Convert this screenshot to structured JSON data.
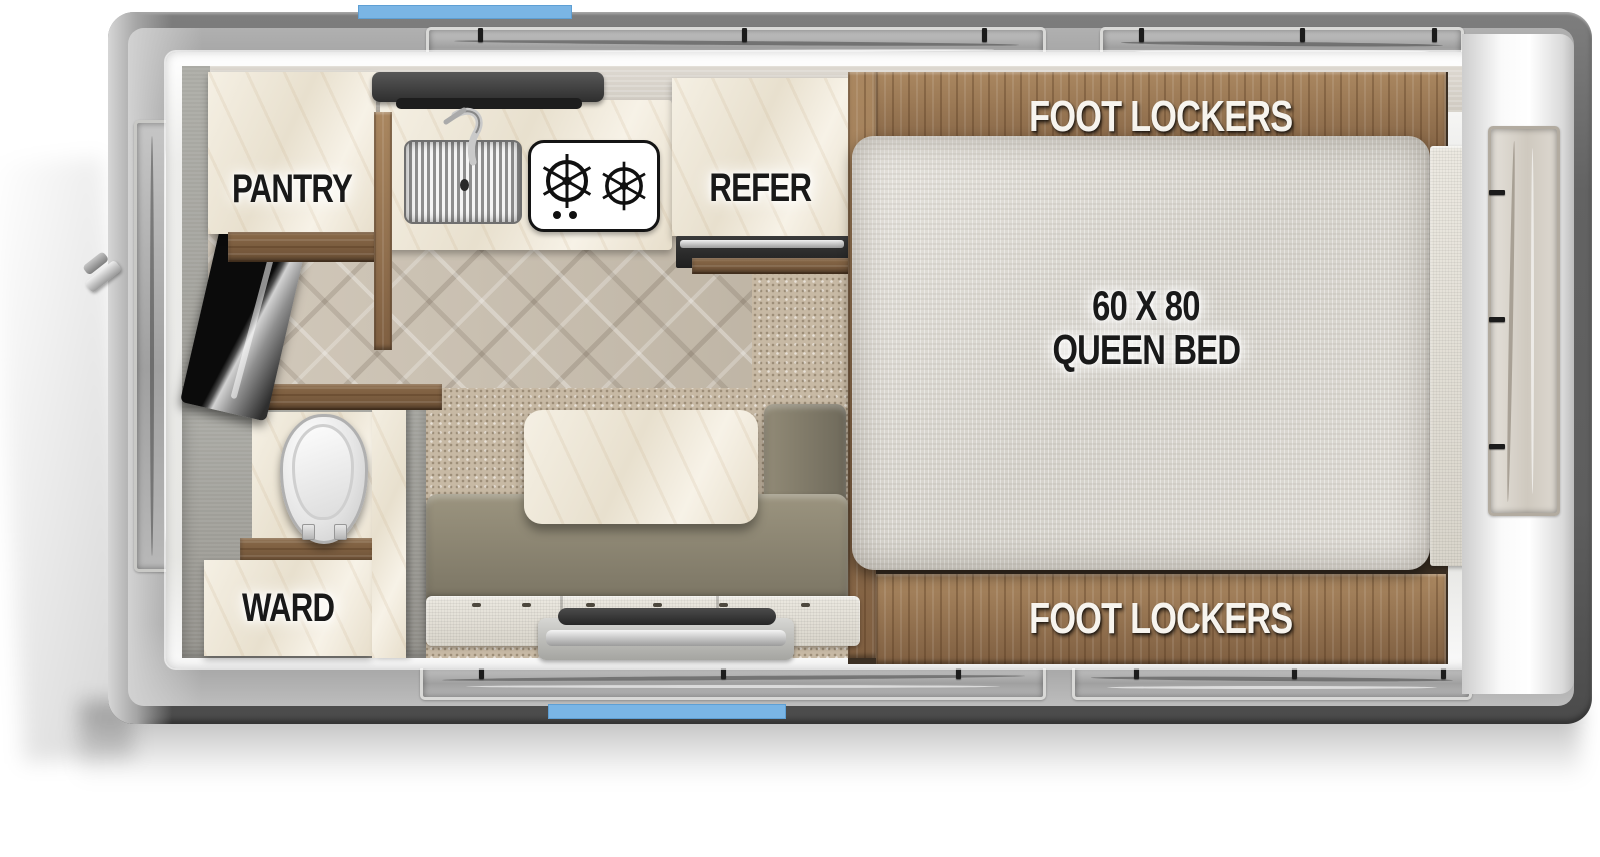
{
  "floorplan": {
    "type": "truck-camper-top-view",
    "accent_color": "#7ab5e5",
    "labels": {
      "pantry": "PANTRY",
      "refer": "REFER",
      "ward": "WARD",
      "foot_lockers_top": "FOOT LOCKERS",
      "foot_lockers_bottom": "FOOT LOCKERS",
      "bed_size": "60 X 80",
      "bed_type": "QUEEN BED"
    }
  }
}
